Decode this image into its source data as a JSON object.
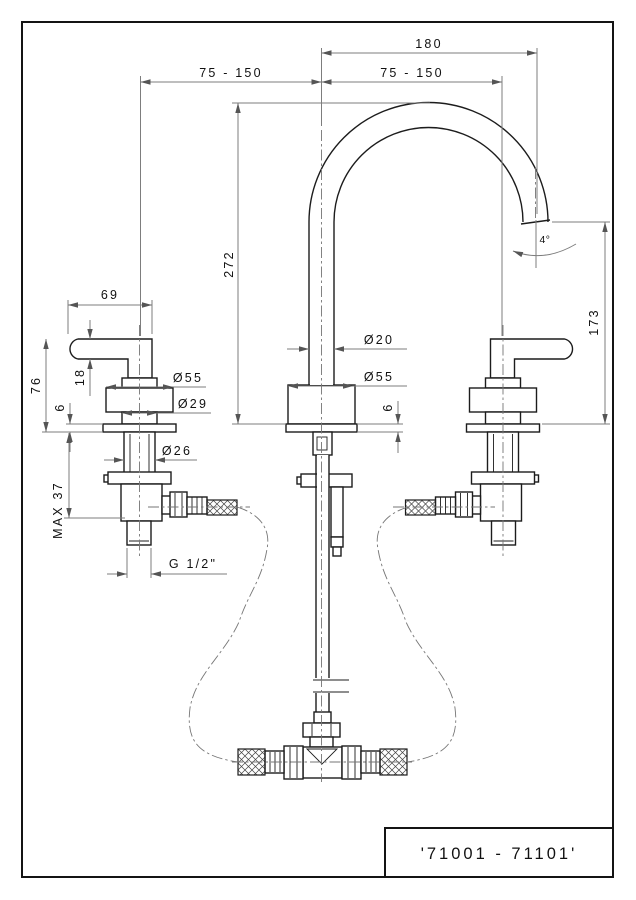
{
  "title_block": {
    "part_code": "'71001 - 71101'"
  },
  "dimensions": {
    "overall_width": "180",
    "left_handle_spacing": "75 - 150",
    "right_handle_spacing": "75 - 150",
    "handle_lever_length": "69",
    "handle_height": "76",
    "lever_thickness": "18",
    "handle_base_height": "6",
    "handle_escutcheon_dia": "Ø55",
    "handle_neck_dia": "Ø29",
    "shank_dia": "Ø26",
    "max_deck_thickness": "MAX 37",
    "thread_size": "G 1/2\"",
    "spout_height": "272",
    "spout_tube_dia": "Ø20",
    "spout_base_dia": "Ø55",
    "spout_base_height": "6",
    "spout_outlet_height": "173",
    "outlet_angle": "4°"
  }
}
